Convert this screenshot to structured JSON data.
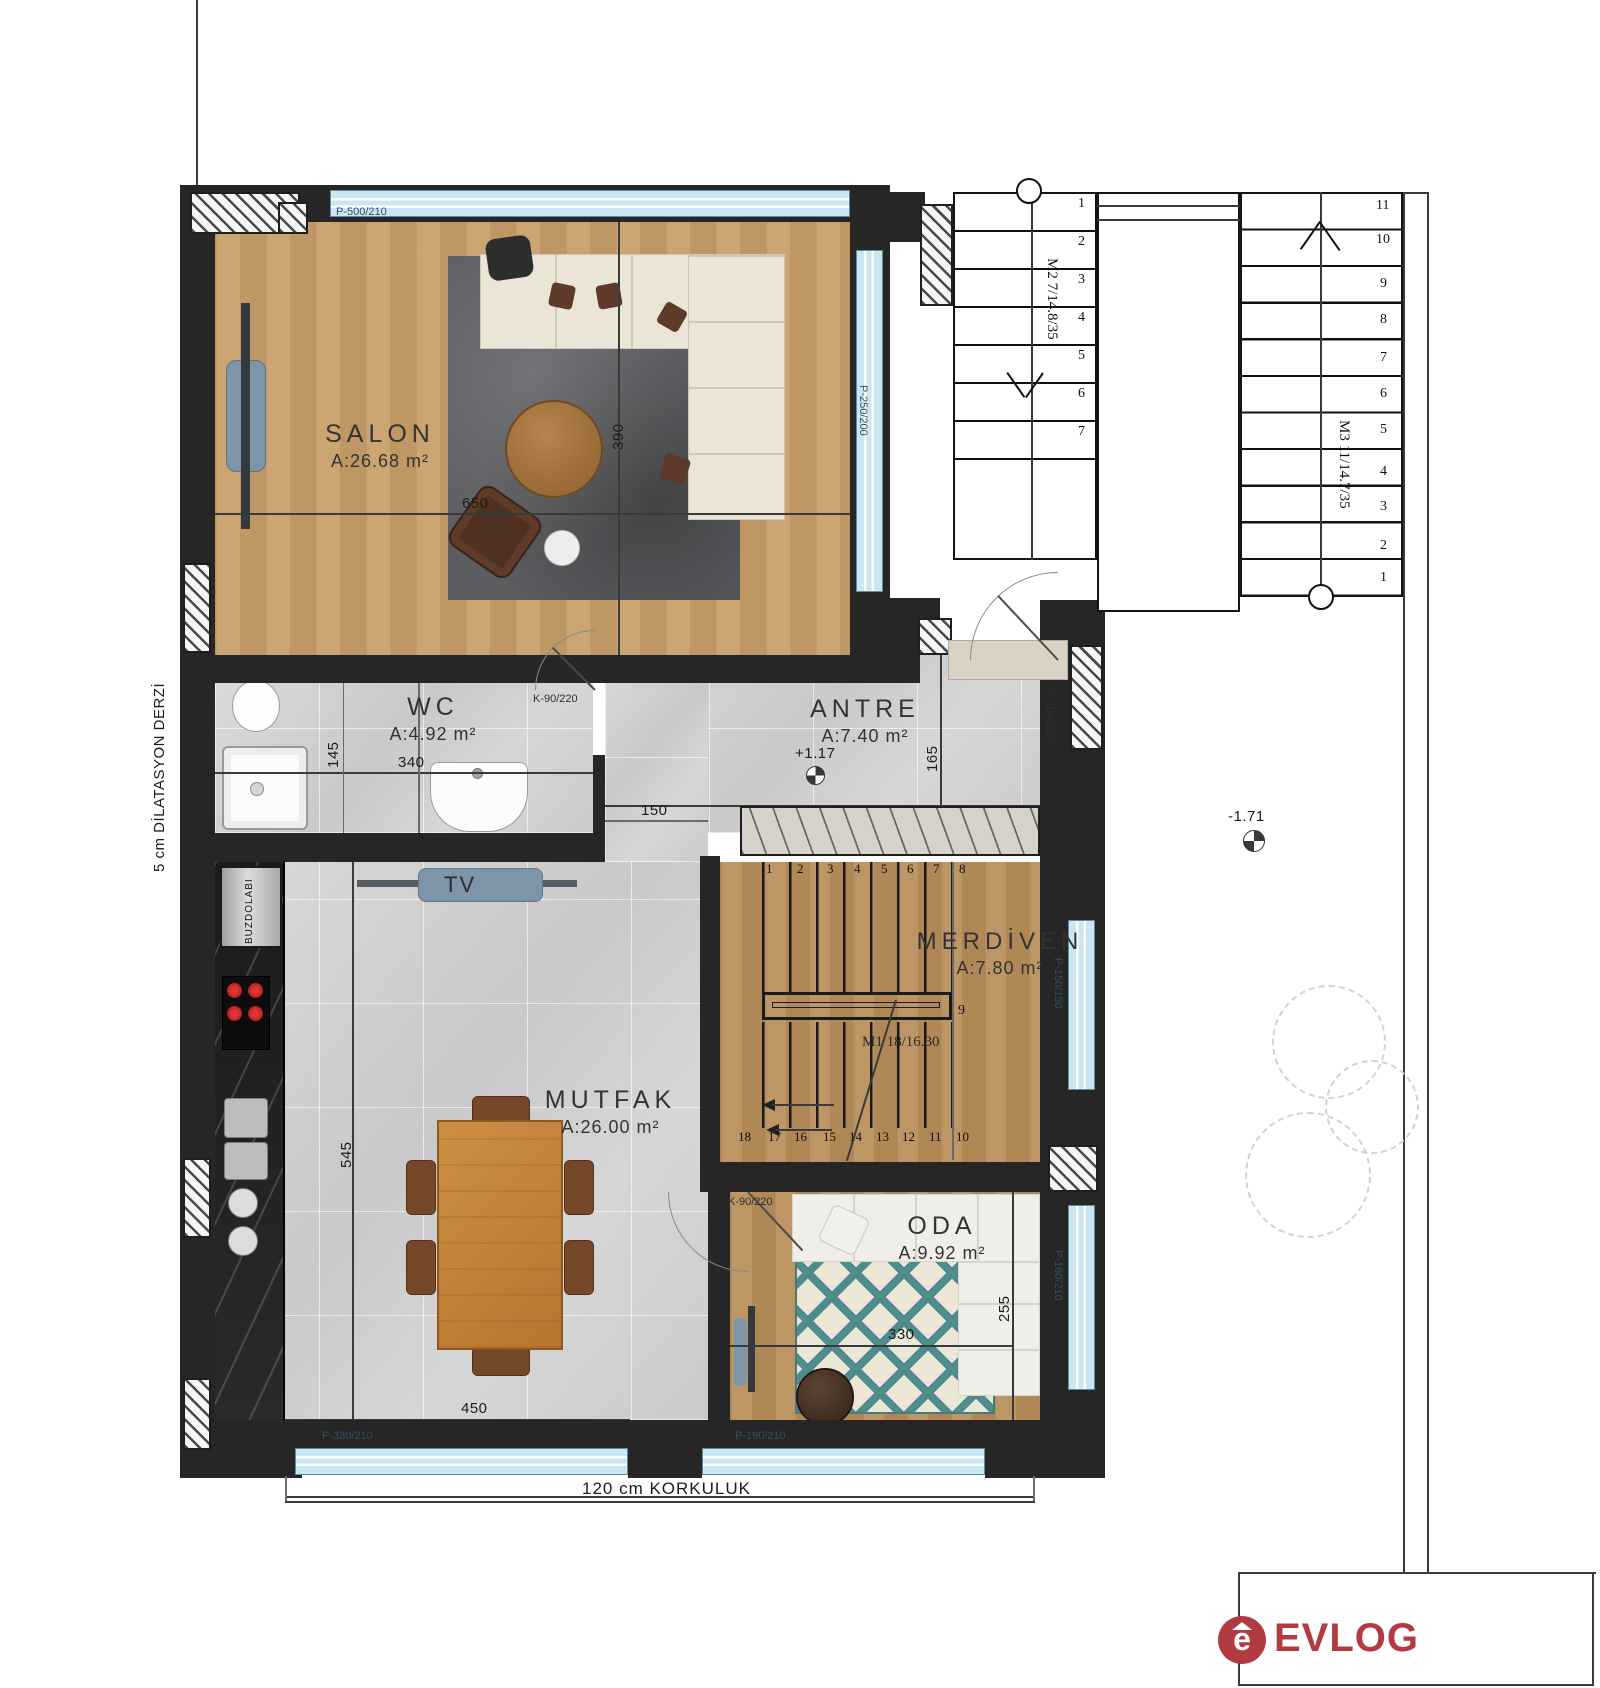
{
  "colors": {
    "accent_red": "#b23a41",
    "glass_blue": "#c9e6f2",
    "rug_teal": "#4f8c8b",
    "wall_dark": "#262626"
  },
  "rooms": {
    "salon": {
      "name": "SALON",
      "area": "A:26.68 m²"
    },
    "wc": {
      "name": "WC",
      "area": "A:4.92 m²"
    },
    "antre": {
      "name": "ANTRE",
      "area": "A:7.40 m²"
    },
    "merdiven": {
      "name": "MERDİVEN",
      "area": "A:7.80 m²"
    },
    "mutfak": {
      "name": "MUTFAK",
      "area": "A:26.00 m²"
    },
    "oda": {
      "name": "ODA",
      "area": "A:9.92 m²"
    }
  },
  "dims": {
    "salon_w": "650",
    "salon_h": "390",
    "wc_h": "145",
    "wc_w": "340",
    "hall_w": "150",
    "antre_h": "165",
    "mutfak_h": "545",
    "mutfak_w": "450",
    "oda_w": "330",
    "oda_h": "255"
  },
  "openings": {
    "salon_top_window": "P-500/210",
    "salon_right_window": "P-250/200",
    "wc_door": "K-90/220",
    "entry_door": "K-100/220",
    "stair_window": "P-150/150",
    "oda_right_window": "P-160/210",
    "mutfak_bottom_window": "P-330/210",
    "oda_bottom_window": "P-190/210",
    "oda_door": "K-90/220"
  },
  "stairs": {
    "m1_label": "M1 18/16.30",
    "m2_label": "M2  7/14.8/35",
    "m3_label": "M3  11/14.7/35",
    "m2_steps": [
      "1",
      "2",
      "3",
      "4",
      "5",
      "6",
      "7"
    ],
    "m3_steps": [
      "11",
      "10",
      "9",
      "8",
      "7",
      "6",
      "5",
      "4",
      "3",
      "2",
      "1"
    ],
    "inner_top_steps": [
      "1",
      "2",
      "3",
      "4",
      "5",
      "6",
      "7",
      "8"
    ],
    "inner_mid_step": "9",
    "inner_bottom_steps": [
      "18",
      "17",
      "16",
      "15",
      "14",
      "13",
      "12",
      "11",
      "10"
    ]
  },
  "annotations": {
    "dilatation": "5 cm DİLATASYON DERZİ",
    "railing": "120 cm KORKULUK",
    "fridge": "BUZDOLABI",
    "tv": "TV",
    "level_antre": "+1.17",
    "level_site": "-1.71"
  },
  "logo": {
    "text": "EVLOG",
    "icon_letter": "e"
  }
}
